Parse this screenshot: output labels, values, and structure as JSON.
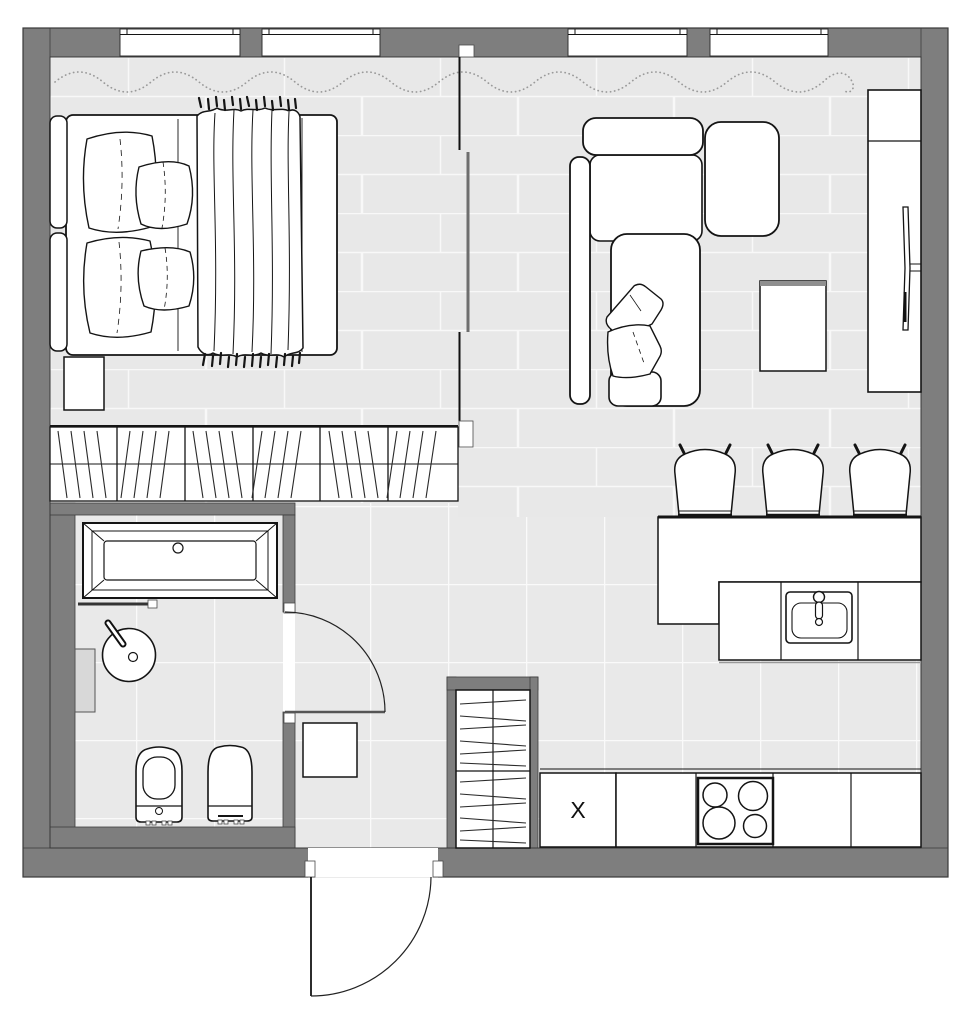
{
  "plan": {
    "kind": "studio-apartment-floor-plan",
    "labels": {
      "appliance": "X"
    },
    "colors": {
      "wall": "#7e7e7e",
      "wall_outline": "#3e3e3e",
      "floor_plank": "#e8e8e8",
      "floor_tile": "#e9e9e9",
      "floor_joint": "#f8f8f8",
      "drawing_line": "#141414",
      "curtain": "#9a9a9a",
      "sliding_panel": "#6e6e6e",
      "background": "#ffffff"
    },
    "symbols": {
      "bedroom": [
        "window",
        "window",
        "curtain-wave",
        "double-bed",
        "headboard-cushions",
        "pillows",
        "blanket-with-fringe",
        "nightstand",
        "built-in-wardrobe-hatched"
      ],
      "living": [
        "window",
        "window",
        "curtain-wave",
        "corner-sofa",
        "sofa-pillows",
        "ottoman-cushion",
        "coffee-table",
        "tv-cabinet",
        "wall-mounted-tv",
        "sliding-partition"
      ],
      "kitchen": [
        "island-bar-counter",
        "bar-stool",
        "bar-stool",
        "bar-stool",
        "kitchen-sink",
        "mixer-tap",
        "cooktop-four-burners",
        "tall-unit-x",
        "base-cabinets"
      ],
      "hall": [
        "entrance-door-swing",
        "entrance-closet-hatched",
        "shoe-cabinet",
        "square-tile-floor"
      ],
      "bathroom": [
        "bathtub",
        "shower-screen",
        "round-washbasin",
        "basin-tap",
        "wall-shelf",
        "wall-hung-toilet",
        "bidet",
        "bathroom-door-swing"
      ]
    }
  }
}
